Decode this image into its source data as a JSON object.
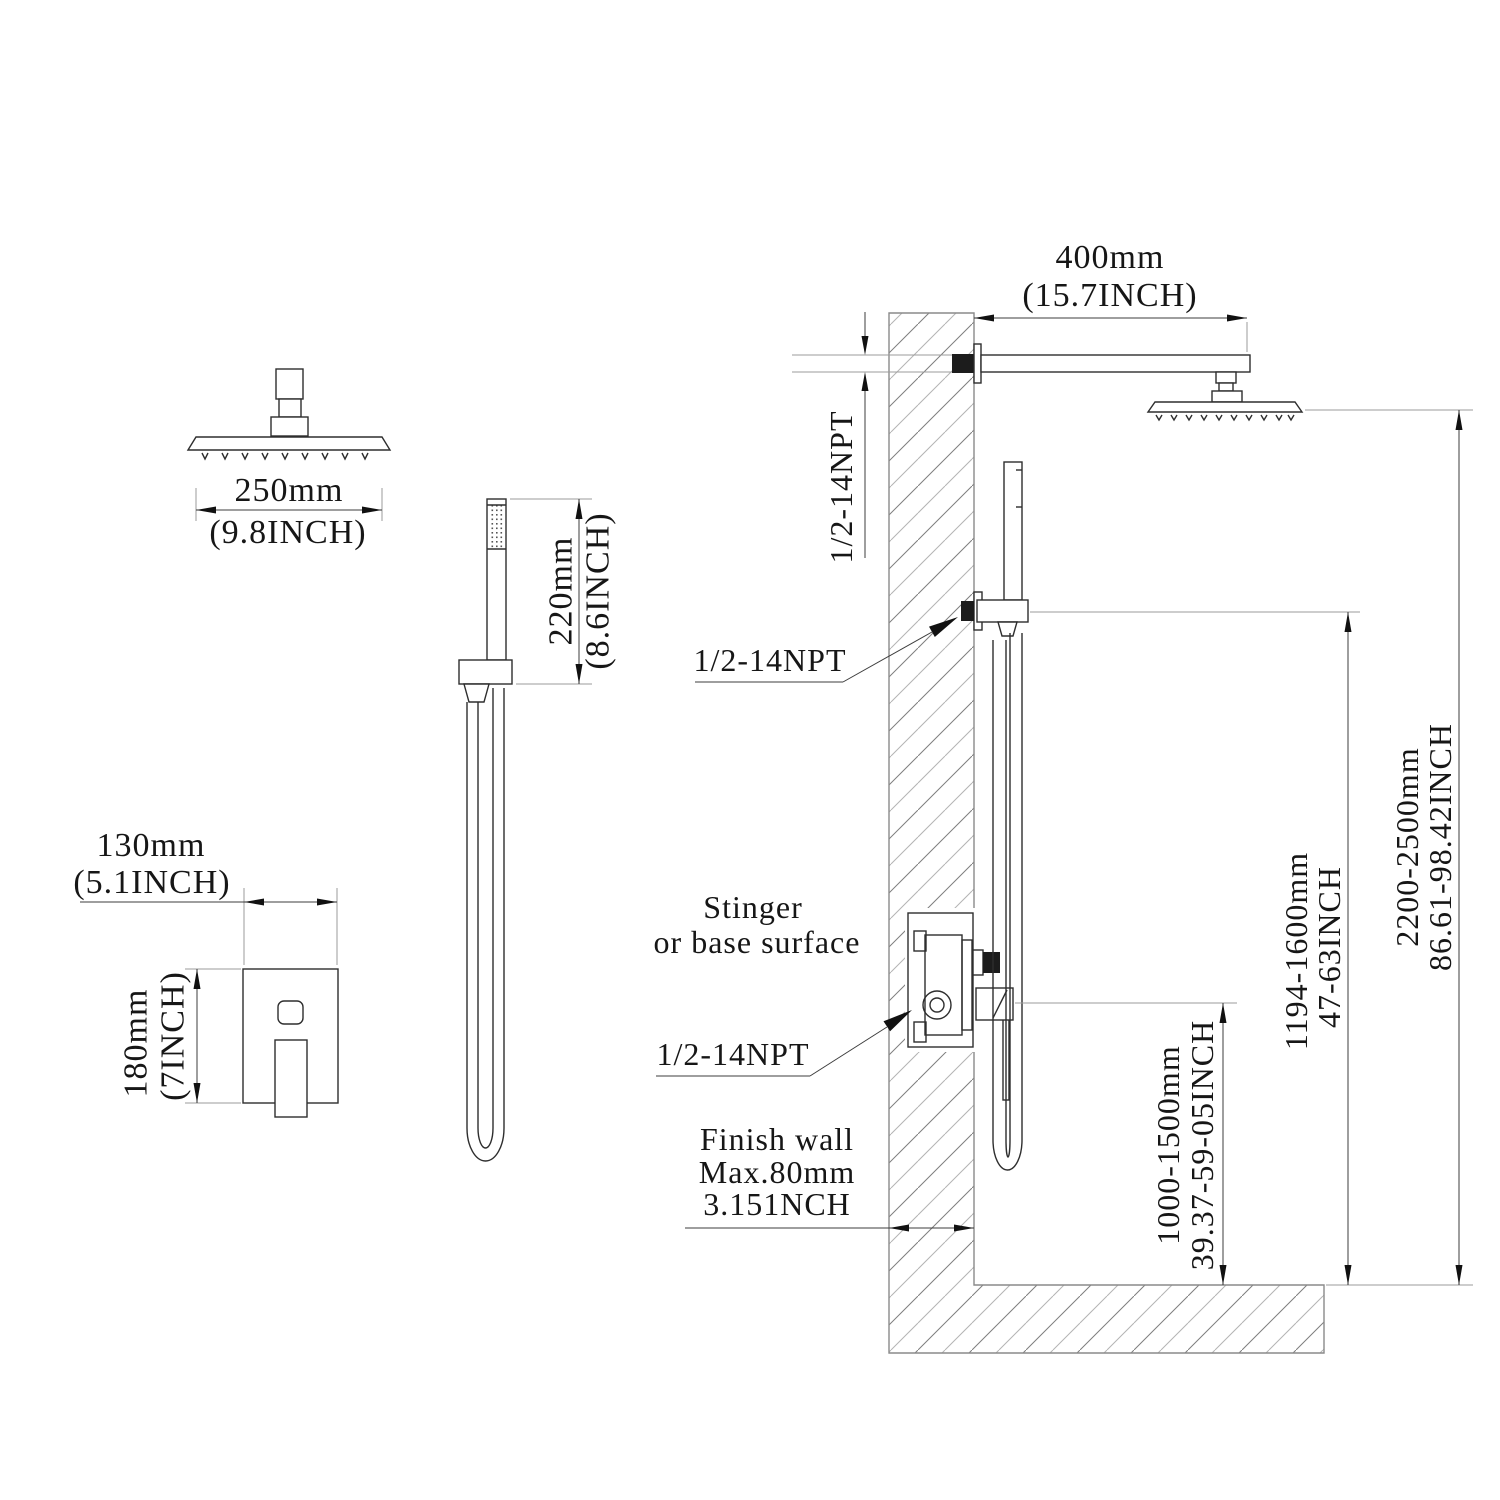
{
  "drawing": {
    "overhead_head": {
      "width_mm": "250mm",
      "width_in": "(9.8INCH)"
    },
    "hand_shower": {
      "length_mm": "220mm",
      "length_in": "(8.6INCH)"
    },
    "valve_trim": {
      "width_mm": "130mm",
      "width_in": "(5.1INCH)",
      "height_mm": "180mm",
      "height_in": "(7INCH)"
    },
    "installation": {
      "arm_length_mm": "400mm",
      "arm_length_in": "(15.7INCH)",
      "arm_thread": "1/2-14NPT",
      "outlet_thread": "1/2-14NPT",
      "valve_thread": "1/2-14NPT",
      "surface_note_line1": "Stinger",
      "surface_note_line2": "or base surface",
      "wall_note_line1": "Finish wall",
      "wall_note_line2": "Max.80mm",
      "wall_note_line3": "3.151NCH",
      "total_height_mm": "2200-2500mm",
      "total_height_in": "86.61-98.42INCH",
      "hand_height_mm": "1194-1600mm",
      "hand_height_in": "47-63INCH",
      "valve_height_mm": "1000-1500mm",
      "valve_height_in": "39.37-59-05INCH"
    }
  }
}
